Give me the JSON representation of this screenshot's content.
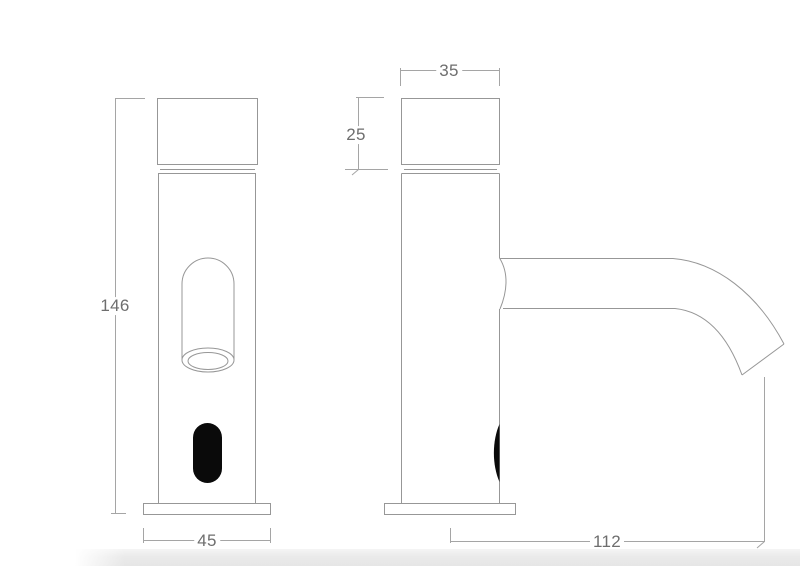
{
  "drawing": {
    "type": "technical-drawing",
    "views": [
      "front",
      "side"
    ],
    "dimensions": {
      "height": "146",
      "base_width": "45",
      "cap_width": "35",
      "cap_height": "25",
      "spout_reach": "112"
    },
    "colors": {
      "outline": "#979797",
      "dimension_line": "#a5a5a5",
      "label_text": "#6e6e6e",
      "sensor_window": "#0a0a0a",
      "floor_band": "#e8e8e8"
    }
  }
}
